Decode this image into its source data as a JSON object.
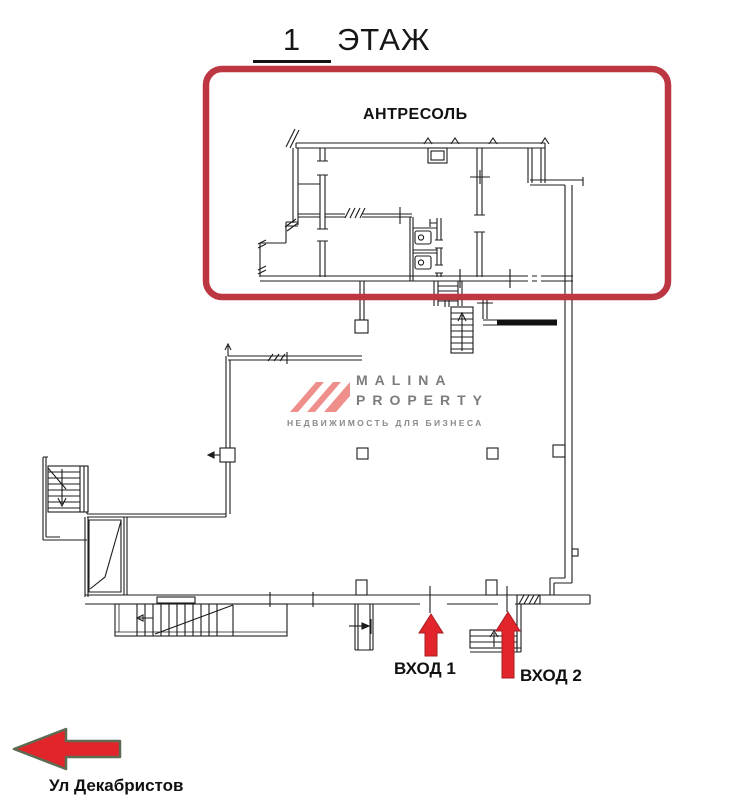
{
  "title": {
    "number": "1",
    "word": "ЭТАЖ"
  },
  "mezzanine": {
    "label": "АНТРЕСОЛЬ"
  },
  "entrances": {
    "entrance1": "ВХОД 1",
    "entrance2": "ВХОД 2"
  },
  "street": {
    "label": "Ул Декабристов"
  },
  "logo": {
    "line1": "MALINA",
    "line2": "PROPERTY",
    "tagline": "НЕДВИЖИМОСТЬ ДЛЯ БИЗНЕСА"
  },
  "colors": {
    "highlight_box_red": "#bc3742",
    "arrow_red": "#e1252b",
    "street_arrow_outline": "#5c6b52",
    "plan_line_black": "#1c1c1c",
    "logo_pink": "#ef8f8c",
    "logo_gray": "#7c7c7c"
  }
}
